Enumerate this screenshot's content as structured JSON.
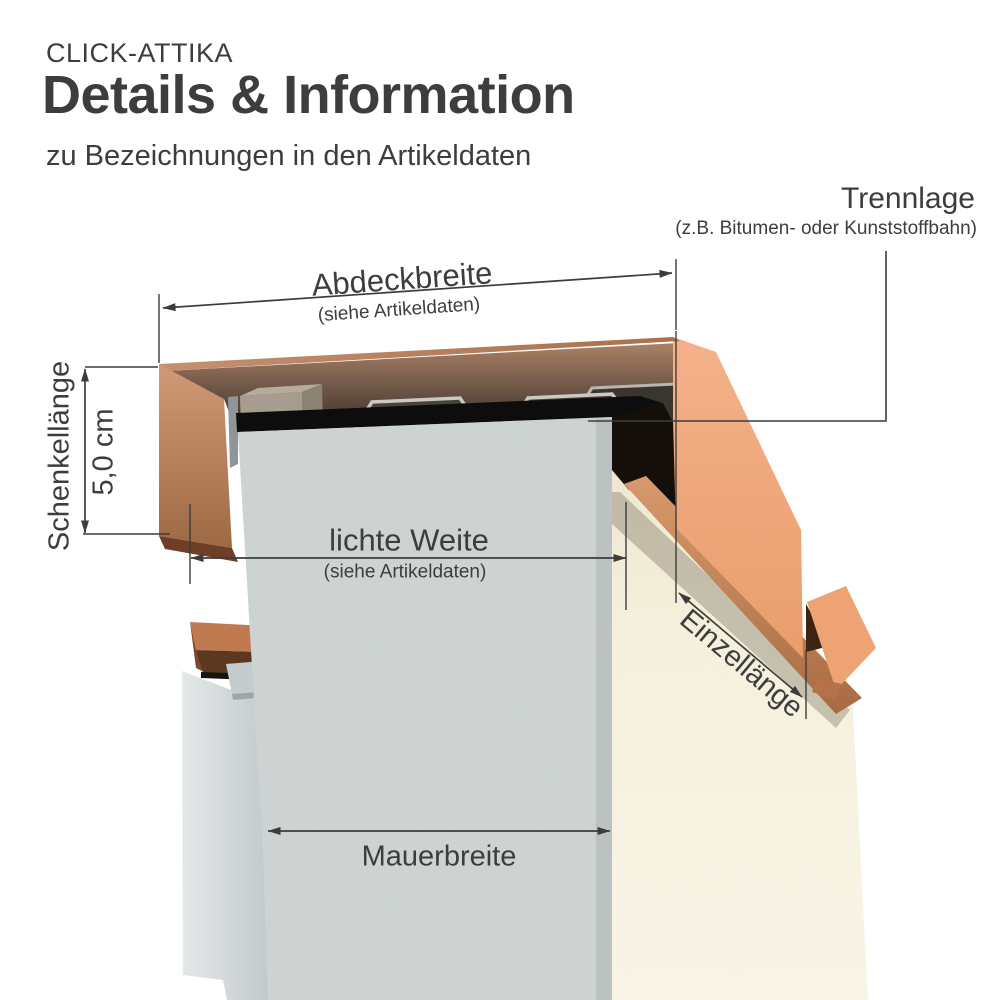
{
  "header": {
    "brand": "CLICK-ATTIKA",
    "title": "Details & Information",
    "subtitle": "zu Bezeichnungen in den Artikeldaten"
  },
  "labels": {
    "trennlage": {
      "title": "Trennlage",
      "note": "(z.B. Bitumen- oder Kunststoffbahn)"
    },
    "abdeckbreite": {
      "title": "Abdeckbreite",
      "note": "(siehe Artikeldaten)"
    },
    "schenkellaenge": {
      "title": "Schenkellänge",
      "value": "5,0 cm"
    },
    "lichte_weite": {
      "title": "lichte Weite",
      "note": "(siehe Artikeldaten)"
    },
    "einzellaenge": {
      "title": "Einzellänge"
    },
    "mauerbreite": {
      "title": "Mauerbreite"
    }
  },
  "colors": {
    "text": "#3d3d3d",
    "dimension_line": "#3c3c3c",
    "copper_end_face": "#efa97b",
    "copper_top_band": "#b8825d",
    "copper_underside_shadow": "#5d3820",
    "separation_membrane": "#0d0d0d",
    "wall_stucco": "#ccd2d1",
    "wall_plaster_cream": "#f8f3e2",
    "wall_rear_gray": "#d8dedf",
    "clip_metal_dark": "#48433d",
    "clip_metal_rim": "#ccc8c2",
    "timber_batten": "#a79d8f"
  }
}
